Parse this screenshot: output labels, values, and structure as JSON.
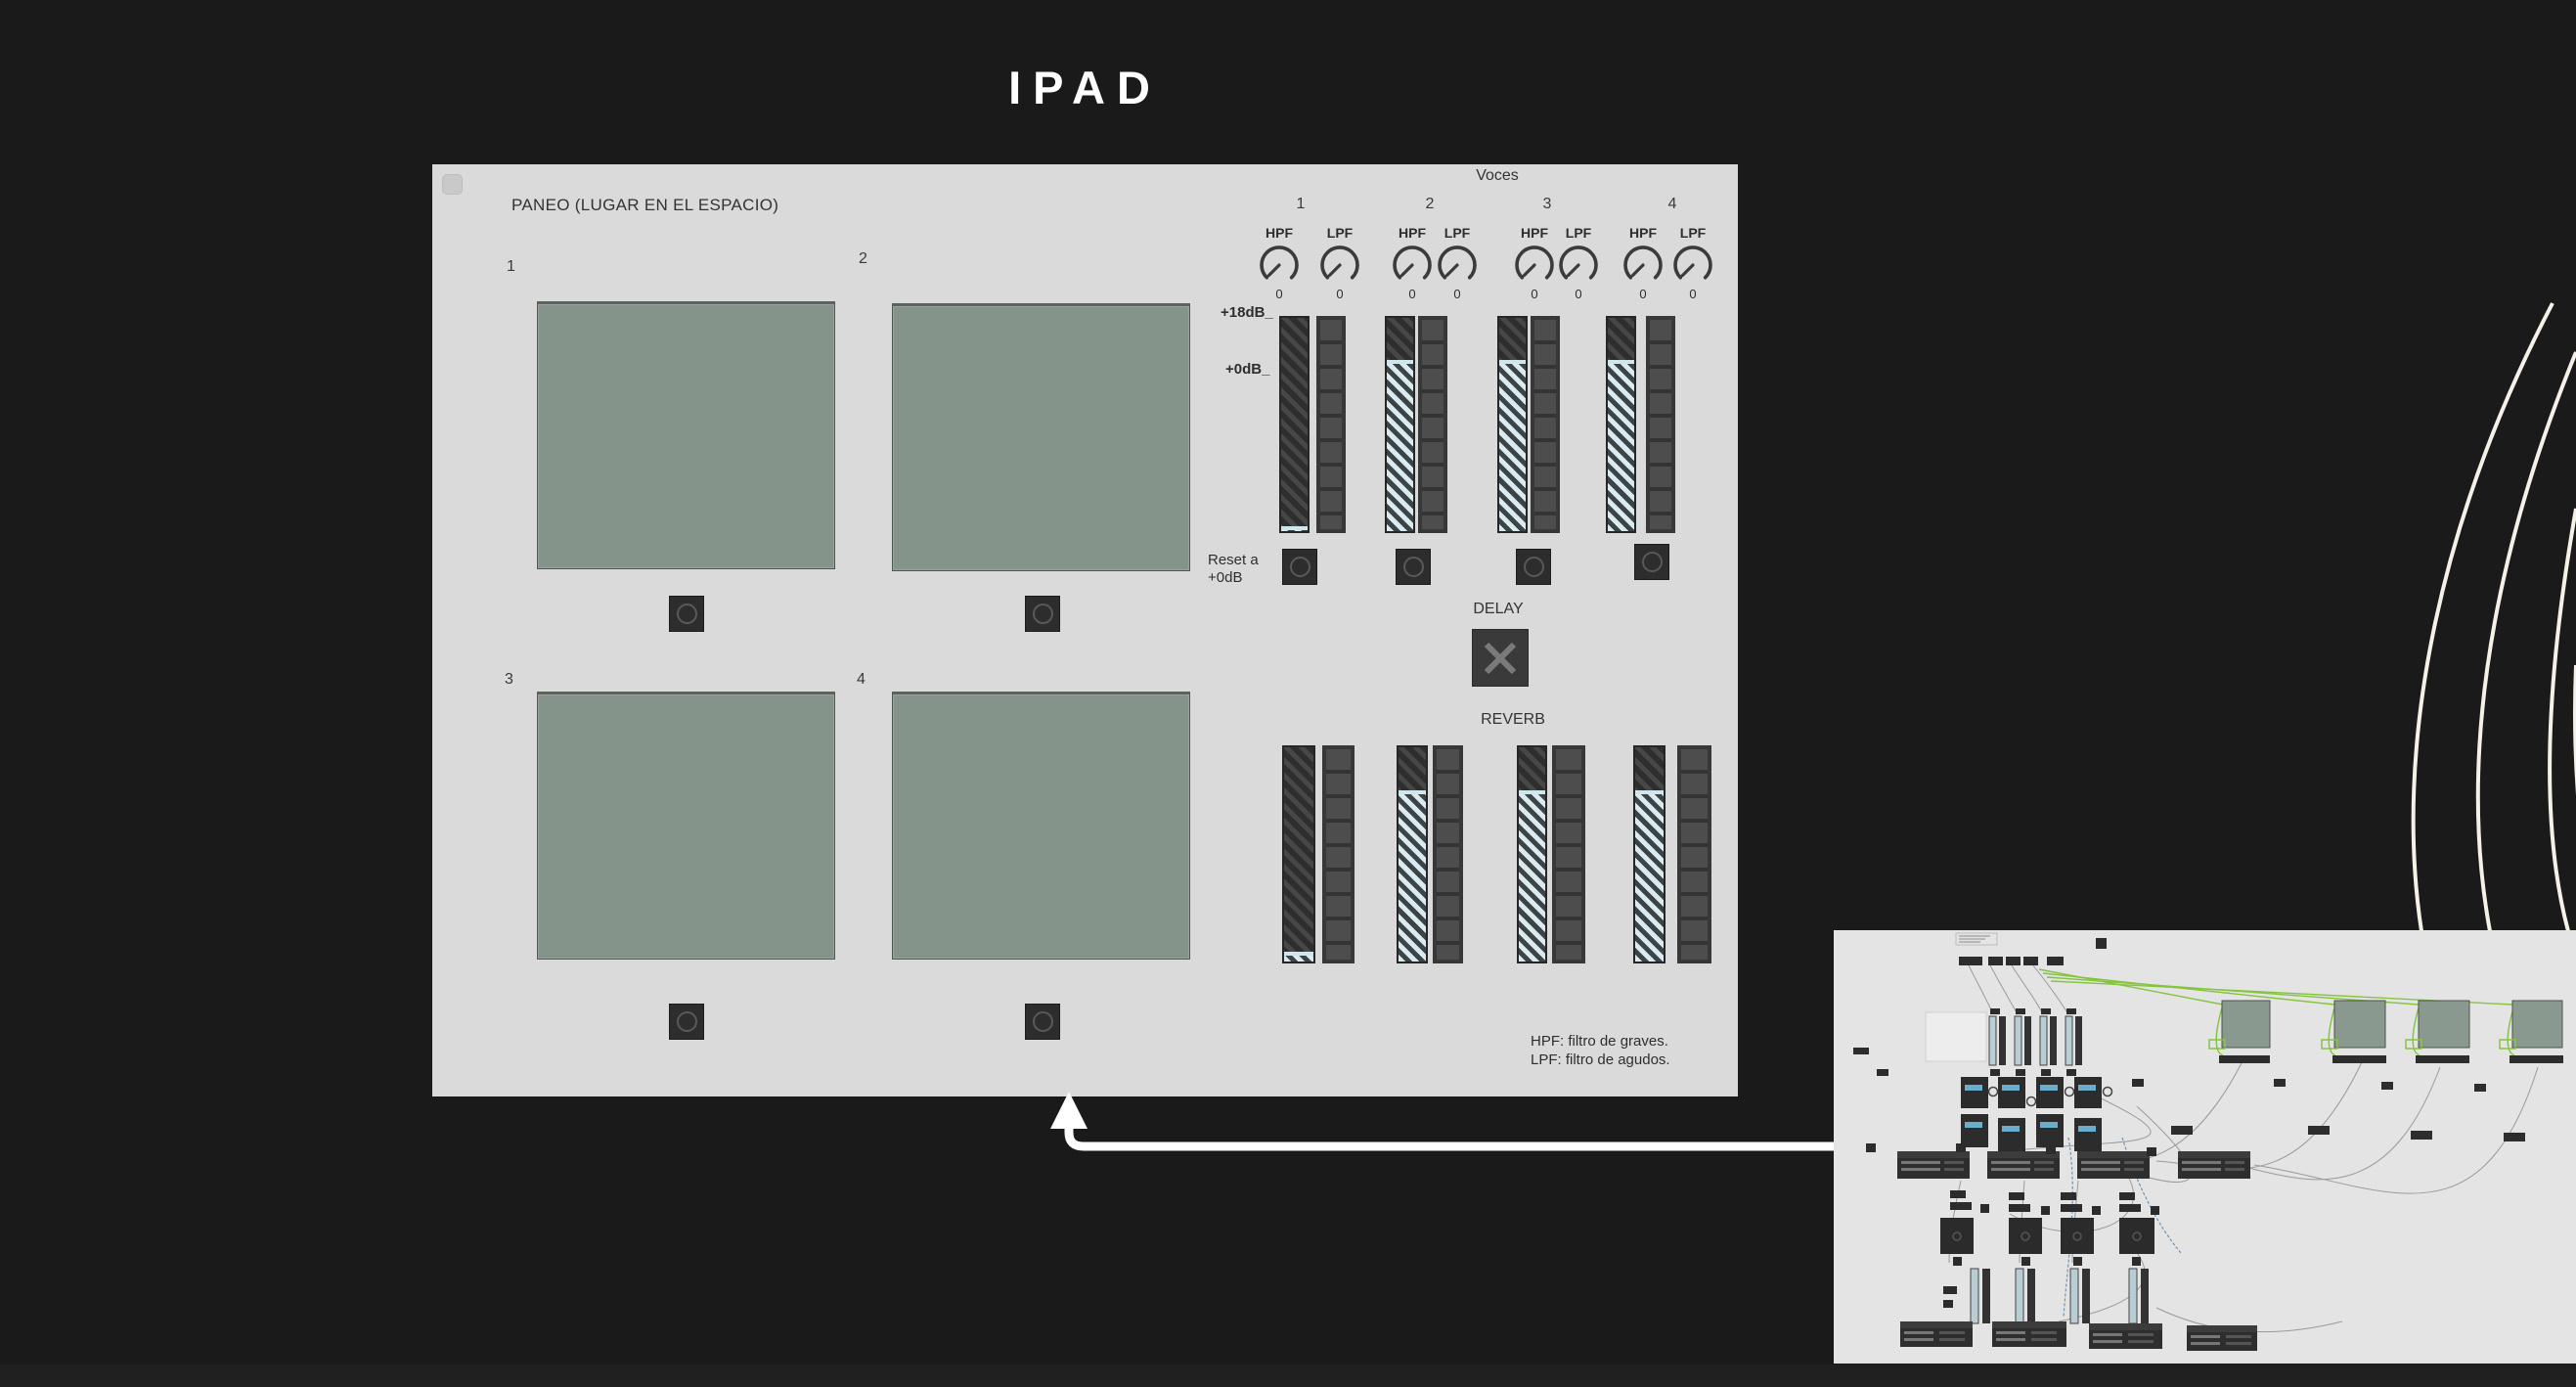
{
  "title": "IPAD",
  "colors": {
    "pad_green": "#85948a",
    "handle_blue": "#cfe6ec",
    "panel_gray": "#dadada",
    "background": "#1a1a1b",
    "wire_green": "#86c440",
    "curve_ivory": "#f6f1e7"
  },
  "panel": {
    "heading": "PANEO (LUGAR EN EL ESPACIO)",
    "pads": [
      {
        "label": "1"
      },
      {
        "label": "2"
      },
      {
        "label": "3"
      },
      {
        "label": "4"
      }
    ],
    "voces": {
      "heading": "Voces",
      "scale_top_label": "+18dB_",
      "scale_zero_label": "+0dB_",
      "reset_line1": "Reset a",
      "reset_line2": "+0dB",
      "voices": [
        {
          "number": "1",
          "hpf_label": "HPF",
          "hpf_value": "0",
          "lpf_label": "LPF",
          "lpf_value": "0",
          "gain_position": 0.975,
          "reverb_position": 0.955
        },
        {
          "number": "2",
          "hpf_label": "HPF",
          "hpf_value": "0",
          "lpf_label": "LPF",
          "lpf_value": "0",
          "gain_position": 0.195,
          "reverb_position": 0.2
        },
        {
          "number": "3",
          "hpf_label": "HPF",
          "hpf_value": "0",
          "lpf_label": "LPF",
          "lpf_value": "0",
          "gain_position": 0.195,
          "reverb_position": 0.2
        },
        {
          "number": "4",
          "hpf_label": "HPF",
          "hpf_value": "0",
          "lpf_label": "LPF",
          "lpf_value": "0",
          "gain_position": 0.195,
          "reverb_position": 0.2
        }
      ]
    },
    "delay_heading": "DELAY",
    "reverb_heading": "REVERB",
    "footnote": [
      "HPF: filtro de graves.",
      "LPF: filtro de agudos."
    ]
  }
}
